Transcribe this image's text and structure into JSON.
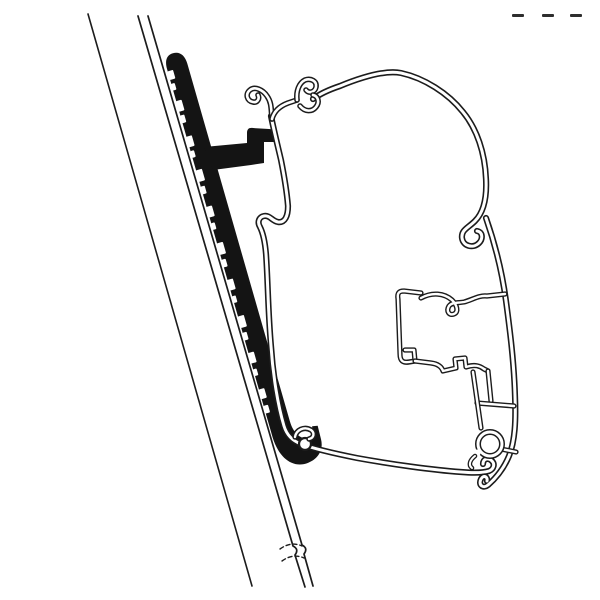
{
  "meta": {
    "description": "Technical line drawing: cross-section of an awning mounting adapter bracket attached to a diagonal wall rail, holding an awning case profile",
    "paper": "#ffffff",
    "ink": "#1c1c1c",
    "adapter_fill": "#141414",
    "mark_color": "#2e2e2e"
  },
  "canvas": {
    "width": 600,
    "height": 600
  },
  "drawing": {
    "elements": [
      {
        "name": "adapter-bracket-body",
        "kind": "fill",
        "transform": "translate(163,55) rotate(-16)",
        "d": "M 0,15 C 0,5 4,1 10,1 C 17,1 21,6 21,15 L 21,387 C 21,399 26,407 34,409 C 37,409.5 39,408 40,404 L 41,398 L 46.5,399 L 46,413 C 45.5,424 38,431 27,432 C 12,433.5 0.5,421 0,398 Z"
      },
      {
        "name": "adapter-bracket-teeth",
        "kind": "rects",
        "transform": "translate(163,55) rotate(-16)",
        "fill": "#ffffff",
        "items": [
          {
            "x": -0.5,
            "y": 17,
            "w": 6,
            "h": 9
          },
          {
            "x": -0.5,
            "y": 30,
            "w": 4,
            "h": 7
          },
          {
            "x": -0.5,
            "y": 48,
            "w": 6,
            "h": 11
          },
          {
            "x": -0.5,
            "y": 63,
            "w": 4.5,
            "h": 8
          },
          {
            "x": -0.5,
            "y": 85,
            "w": 6,
            "h": 11
          },
          {
            "x": -0.5,
            "y": 100,
            "w": 4,
            "h": 7
          },
          {
            "x": -0.5,
            "y": 120,
            "w": 6.5,
            "h": 12
          },
          {
            "x": -0.5,
            "y": 137,
            "w": 4.5,
            "h": 8
          },
          {
            "x": -0.5,
            "y": 158,
            "w": 6,
            "h": 11
          },
          {
            "x": -0.5,
            "y": 175,
            "w": 4,
            "h": 7
          },
          {
            "x": -0.5,
            "y": 196,
            "w": 6.5,
            "h": 12
          },
          {
            "x": -0.5,
            "y": 213,
            "w": 4.5,
            "h": 8
          },
          {
            "x": -0.5,
            "y": 234,
            "w": 6,
            "h": 11
          },
          {
            "x": -0.5,
            "y": 251,
            "w": 4,
            "h": 7
          },
          {
            "x": -0.5,
            "y": 272,
            "w": 6.5,
            "h": 12
          },
          {
            "x": -0.5,
            "y": 289,
            "w": 4.5,
            "h": 8
          },
          {
            "x": -0.5,
            "y": 310,
            "w": 6,
            "h": 11
          },
          {
            "x": -0.5,
            "y": 327,
            "w": 4,
            "h": 7
          },
          {
            "x": -0.5,
            "y": 348,
            "w": 6,
            "h": 10
          },
          {
            "x": -0.5,
            "y": 365,
            "w": 5,
            "h": 8
          }
        ]
      },
      {
        "name": "adapter-arm-hook",
        "kind": "fill",
        "d": "M 204,147 L 247,143 L 247,133 C 247,129 249,127.5 253,128 L 269,129 C 273,129.3 275,131 274.5,135 L 274,142 L 264,142 L 264,163 L 251,165 L 213,170 Z"
      },
      {
        "name": "wall-outer-line",
        "kind": "line",
        "w": 1.6,
        "d": "M 88,14 L 252,586"
      },
      {
        "name": "wall-panel-line-left",
        "kind": "line",
        "w": 1.7,
        "d": "M 138,16 L 293,546 C 297,548 298,551 295,555 L 305,587"
      },
      {
        "name": "wall-panel-line-right",
        "kind": "line",
        "w": 1.7,
        "d": "M 148,16 L 302,545 C 306,547 307,550 304,554 L 313,586"
      },
      {
        "name": "wall-break-dash-upper",
        "kind": "line",
        "w": 1.4,
        "dash": "4 3",
        "d": "M 280,549 Q 291,541 302,546"
      },
      {
        "name": "wall-break-dash-lower",
        "kind": "line",
        "w": 1.4,
        "dash": "4 3",
        "d": "M 282,561 Q 293,553 304,558"
      },
      {
        "name": "profile-flange-and-bottom-lip",
        "kind": "tube",
        "outer": 6.2,
        "inner": 3,
        "d": "M 271,116 C 274,131 278,147 281,160 C 284,175 287,194 288,206 C 288,216 285,223 278,222 C 272,221 270,215 264,216 C 259,217 257,222 260,227 C 263,233 265,242 266,254 C 268,283 268,312 271,346 C 273,376 278,406 284,426 C 287,436 293,441 301,444 C 312,448 332,453 357,458 C 390,464 432,470 461,472 C 473,473 483,473 489,471 C 494,469 495,464 492,461 C 488,457 483,459 483,464"
      },
      {
        "name": "profile-top-curve",
        "kind": "tube",
        "outer": 6.2,
        "inner": 3,
        "d": "M 313,99 C 321,93 331,89 340,86 C 362,77 386,70 401,73 C 424,78 448,93 463,112 C 477,129 485,153 486,179 C 487,199 483,213 475,221 C 468,228 461,230 462,238 C 463,246 473,249 479,243 C 483,239 483,232 477,231"
      },
      {
        "name": "profile-right-wall",
        "kind": "tube",
        "outer": 6.2,
        "inner": 3,
        "d": "M 486,218 C 494,241 502,271 506,301 C 510,331 514,362 515,396 C 516,421 515,441 509,456 C 504,468 496,478 488,485 C 483,489 478,485 481,479 C 483,475 488,476 487,481"
      },
      {
        "name": "profile-top-left-curl-hook",
        "kind": "tube",
        "outer": 5.6,
        "inner": 2.6,
        "d": "M 272,119 C 271,110 272,103 267,96 C 263,90 255,86 250,90 C 245,94 247,101 253,102 C 257,103 260,99 258,95"
      },
      {
        "name": "profile-top-link",
        "kind": "tube",
        "outer": 5.6,
        "inner": 2.6,
        "d": "M 272,119 C 274,111 280,106 288,103 L 297,100"
      },
      {
        "name": "profile-top-claw-hook-a",
        "kind": "tube",
        "outer": 5.6,
        "inner": 2.6,
        "d": "M 297,100 C 296,91 299,83 305,80 C 311,78 317,81 316,87 C 315,92 309,94 306,90"
      },
      {
        "name": "profile-top-claw-hook-b",
        "kind": "tube",
        "outer": 5.6,
        "inner": 2.6,
        "d": "M 300,106 C 305,112 312,112 316,107 C 320,102 318,96 313,95"
      },
      {
        "name": "rib-upper-left-hooks",
        "kind": "tube",
        "outer": 5.2,
        "inner": 2.4,
        "d": "M 421,293 L 404,291 C 399,291 397,293 398,299 L 400,354 C 400,361 403,363 409,362 L 415,361 L 414,350 L 405,350"
      },
      {
        "name": "rib-top-wavy-with-loop",
        "kind": "tube",
        "outer": 5.2,
        "inner": 2.4,
        "d": "M 421,298 C 432,292 444,293 452,300 C 457,305 459,312 454,314 C 449,316 446,311 449,306 C 452,302 459,303 464,302 C 472,300 479,295 487,296 L 505,294"
      },
      {
        "name": "rib-bottom-zigzag",
        "kind": "tube",
        "outer": 5.2,
        "inner": 2.4,
        "d": "M 415,361 L 431,363 C 439,364 442,368 443,371 L 456,368 L 455,359 L 465,358 L 466,367 C 475,364 480,366 484,369 L 488,371"
      },
      {
        "name": "rib-node-drop",
        "kind": "tube",
        "outer": 5.2,
        "inner": 2.4,
        "d": "M 488,371 L 491,401"
      },
      {
        "name": "rib-horizontal-to-wall",
        "kind": "tube",
        "outer": 5.2,
        "inner": 2.4,
        "d": "M 477,403 L 514,406"
      },
      {
        "name": "rib-strut-to-ring",
        "kind": "tube",
        "outer": 5.2,
        "inner": 2.4,
        "d": "M 473,372 L 481,428"
      },
      {
        "name": "rib-ring-to-wall",
        "kind": "tube",
        "outer": 5.2,
        "inner": 2.4,
        "d": "M 501,449 L 516,452"
      },
      {
        "name": "screw-boss-ring",
        "kind": "tube-circle",
        "cx": 490,
        "cy": 444,
        "r": 12,
        "outer": 6,
        "inner": 3
      },
      {
        "name": "screw-boss-ring-gap",
        "kind": "line",
        "w": 7,
        "color": "#ffffff",
        "d": "M 477,453 L 471,460"
      },
      {
        "name": "screw-boss-ring-tail",
        "kind": "tube",
        "outer": 4.6,
        "inner": 2,
        "d": "M 475,456 C 470,460 468,465 472,468"
      },
      {
        "name": "lip-curl-eye",
        "kind": "circle",
        "cx": 305,
        "cy": 444,
        "r": 6,
        "fill": "#ffffff",
        "stroke": "#1c1c1c",
        "w": 2.2
      },
      {
        "name": "lip-curl-beak",
        "kind": "tube",
        "outer": 5.4,
        "inner": 2.4,
        "d": "M 295,437 C 296,430 304,426 311,430 C 315,433 314,438 309,439"
      },
      {
        "name": "cropped-mark-dashes",
        "kind": "rects",
        "fill": "#2e2e2e",
        "items": [
          {
            "x": 512,
            "y": 14,
            "w": 12,
            "h": 3
          },
          {
            "x": 542,
            "y": 14,
            "w": 12,
            "h": 3
          },
          {
            "x": 570,
            "y": 14,
            "w": 12,
            "h": 3
          }
        ]
      }
    ]
  }
}
